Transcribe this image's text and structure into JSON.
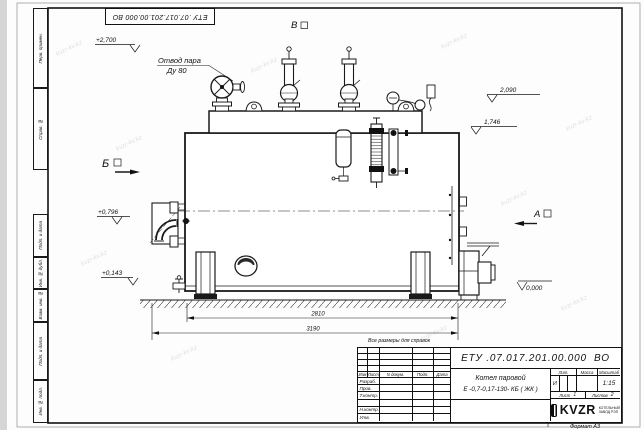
{
  "frame": {
    "corner_stamp": "ЕТУ .07.017.201.00.000  ВО",
    "format_label": "Формат А3",
    "margin_boxes": [
      "Перв. примен.",
      "Справ. №",
      "Подп. и дата",
      "Инв. № дубл.",
      "Взам. инв. №",
      "Подп. и дата",
      "Инв. № подл."
    ]
  },
  "drawing": {
    "steam_outlet_label_1": "Отвод пара",
    "steam_outlet_label_2": "Ду 80",
    "note": "Все размеры для справок",
    "views": {
      "a": "А",
      "b": "Б",
      "v": "В"
    },
    "elevations": {
      "top_left": "+2,700",
      "right_upper": "2,090",
      "right_lower": "1,746",
      "left_upper": "+0,796",
      "left_lower": "+0,143",
      "ground": "0,000"
    },
    "dimensions": {
      "inner": "2810",
      "overall": "3190"
    }
  },
  "title_block": {
    "doc_number": "ЕТУ .07.017.201.00.000  ВО",
    "product_name_1": "Котел паровой",
    "product_name_2": "Е -0,7-0,17-130- КБ ( ЖК )",
    "header_cols": {
      "izm": "Изм",
      "list": "Лист",
      "doc": "N докум.",
      "podp": "Подп.",
      "data": "Дата"
    },
    "role_rows": [
      "Разраб.",
      "Пров.",
      "Т.контр.",
      "",
      "Н.контр.",
      "Утв."
    ],
    "lit_label": "Лит.",
    "lit_value": "И",
    "mass_label": "Масса",
    "scale_label": "Масштаб",
    "scale_value": "1:15",
    "sheet_label": "Лист",
    "sheet_value": "1",
    "sheets_label": "Листов",
    "sheets_value": "2",
    "logo_text": "KVZR",
    "logo_sub_1": "КОТЕЛЬНЫЙ",
    "logo_sub_2": "ЗАВОД РЭП"
  },
  "watermark": "kvzr-kv.kz"
}
